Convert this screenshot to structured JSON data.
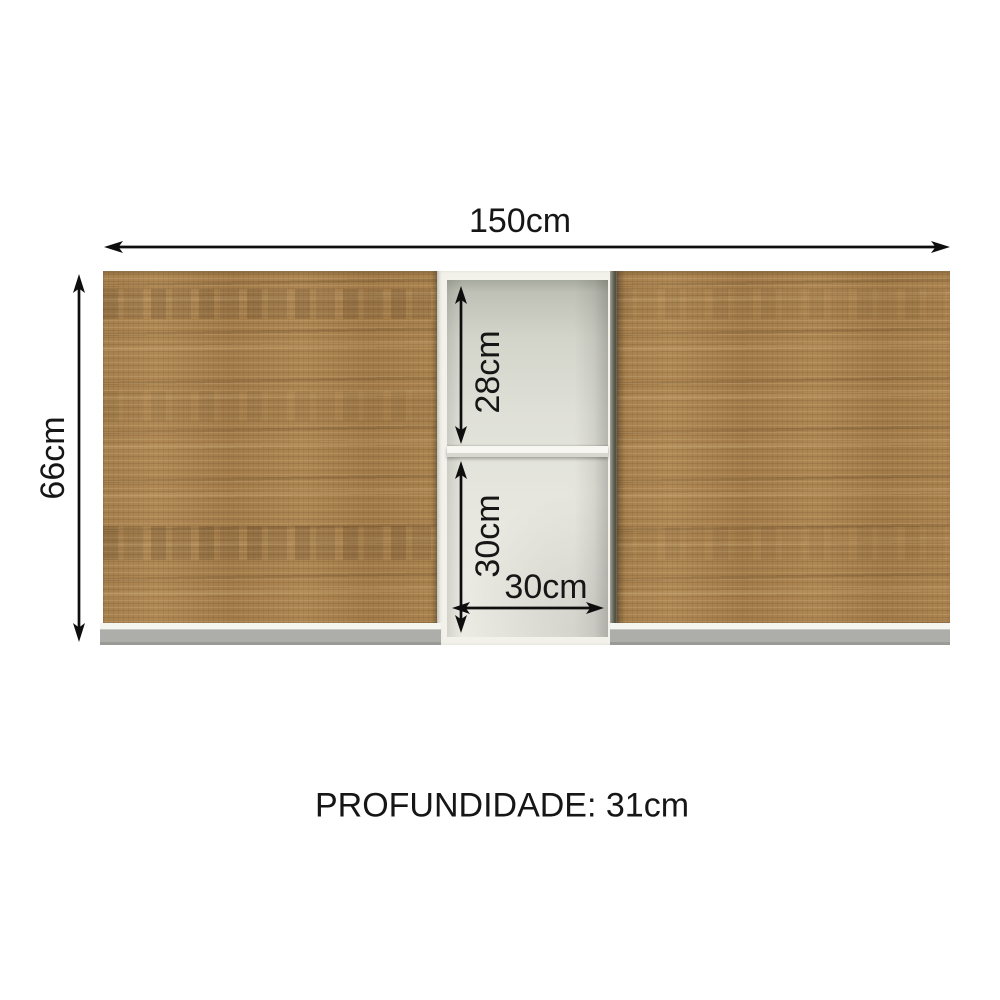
{
  "diagram": {
    "width_label": "150cm",
    "height_label": "66cm",
    "top_shelf_label": "28cm",
    "bottom_shelf_label": "30cm",
    "shelf_width_label": "30cm",
    "depth_label": "PROFUNDIDADE: 31cm"
  },
  "colors": {
    "dimension_ink": "#0e0e0e",
    "wood_left_door": "#a8814e",
    "wood_right_door": "#b18e5c",
    "carcass_white": "#f2f1ea",
    "niche_interior": "#d9dad0",
    "plinth_gray": "#adadaa",
    "background": "#ffffff"
  }
}
